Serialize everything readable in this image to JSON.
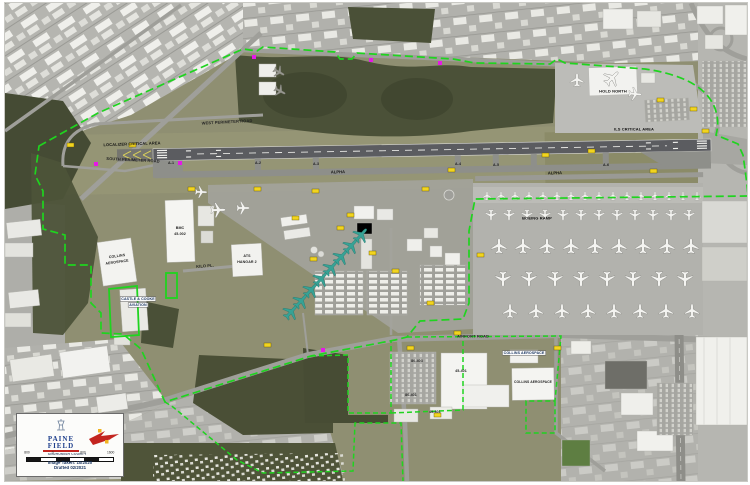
{
  "title": "Paine Field Snohomish County Airport - Aerial Drafting Map",
  "colors": {
    "boundary_green": "#1fd41f",
    "marker_magenta": "#e618e6",
    "marker_yellow": "#f2d41f",
    "plane_teal": "#37a295",
    "legend_blue": "#1d3e8c",
    "legend_red": "#c3251f"
  },
  "labels": {
    "west_perimeter_road": "WEST PERIMETER ROAD",
    "south_perimeter_road": "SOUTH PERIMETER ROAD",
    "airport_road": "AIRPORT ROAD",
    "kilo_pl": "KILO PL.",
    "localizer_area": "LOCALIZER CRITICAL AREA",
    "ils_area": "ILS CRITICAL AREA",
    "hold_north": "HOLD NORTH",
    "boeing_ramp": "BOEING RAMP",
    "alpha_west": "ALPHA",
    "alpha_east": "ALPHA"
  },
  "taxiways": [
    "A-1",
    "A-2",
    "A-3",
    "A-4",
    "A-5",
    "A-6"
  ],
  "buildings": {
    "collins_w_1": "COLLINS",
    "collins_w_2": "AEROSPACE",
    "bmc_1": "BMC",
    "bmc_2": "45-002",
    "ats_1": "ATS",
    "ats_2": "HANGAR 2",
    "castle_1": "CASTLE & COOKE",
    "castle_2": "AVIATION",
    "collins_s_chip": "COLLINS AEROSPACE",
    "collins_s_roof": "COLLINS AEROSPACE",
    "b45_401": "45-401",
    "b80_403": "80-403",
    "b80_401": "80-401",
    "b45_601": "45-601"
  },
  "legend": {
    "logo_line1": "PAINE",
    "logo_line2": "FIELD",
    "logo_sub": "SNOHOMISH COUNTY",
    "scale_ticks": [
      "800",
      "0",
      "800",
      "1600"
    ],
    "note1": "Image Taken: 10/2020",
    "note2": "Drafted 02/2021"
  }
}
